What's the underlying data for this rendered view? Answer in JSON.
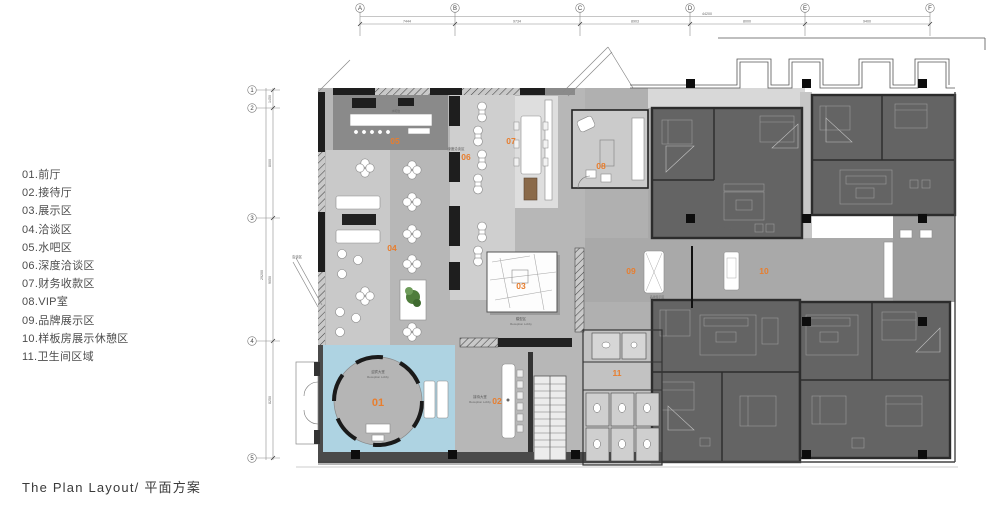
{
  "title": {
    "en": "The Plan Layout/",
    "zh": "平面方案"
  },
  "legend": {
    "items": [
      "01.前厅",
      "02.接待厅",
      "03.展示区",
      "04.洽谈区",
      "05.水吧区",
      "06.深度洽谈区",
      "07.财务收款区",
      "08.VIP室",
      "09.品牌展示区",
      "10.样板房展示休憩区",
      "11.卫生间区域"
    ]
  },
  "grid_top": {
    "letters": [
      "A",
      "B",
      "C",
      "D",
      "E",
      "F"
    ],
    "segment_dims": [
      "7444",
      "9734",
      "8903",
      "8000",
      "9400"
    ],
    "overall_dim": "44200"
  },
  "grid_left": {
    "numbers": [
      "1",
      "2",
      "3",
      "4",
      "5"
    ],
    "segment_dims": [
      "1450",
      "8000",
      "9050",
      "8250"
    ],
    "overall_dim": "29200"
  },
  "plan": {
    "room_labels": [
      "01",
      "02",
      "03",
      "04",
      "05",
      "06",
      "07",
      "08",
      "09",
      "10",
      "11"
    ],
    "annotations": [
      "洽谈区",
      "深度洽谈区",
      "迎宾大堂",
      "Reception Lobby",
      "接待大堂",
      "Reception Lobby",
      "模型区",
      "Reception Lobby",
      "品牌展示区",
      "户型平面图展示区",
      "水吧台"
    ],
    "colors": {
      "accent_orange": "#e87e2e",
      "showroom_floor": "#b7b7b7",
      "lounge_floor": "#c9c9c9",
      "corridor_floor": "#a9a9a9",
      "sample_unit": "#646464",
      "water_blue": "#aed3e2"
    }
  }
}
